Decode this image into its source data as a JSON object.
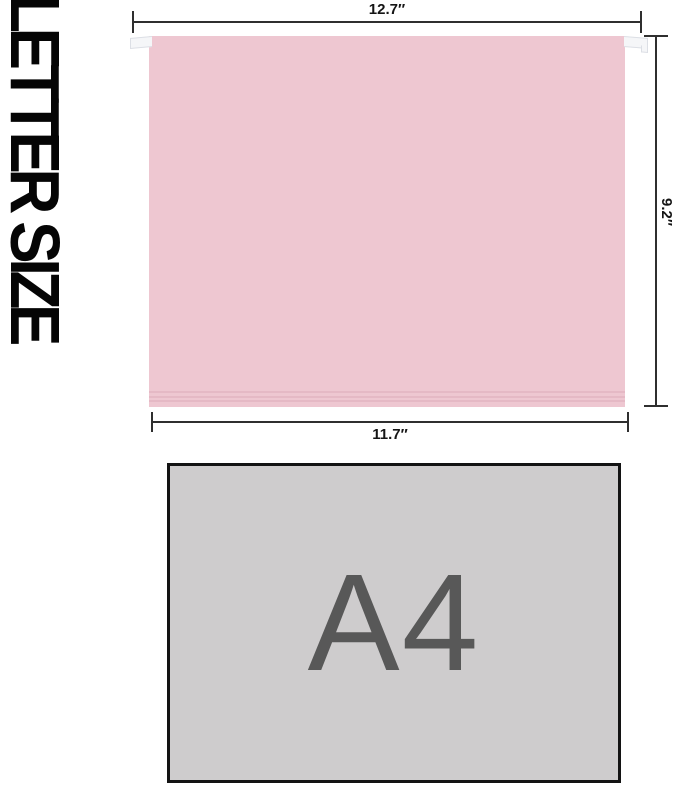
{
  "title": {
    "text": "LETTER SIZE"
  },
  "folder": {
    "type": "letter-size hanging file folder",
    "color": "#eec7d1",
    "top_width_label": "12.7″",
    "height_label": "9.2″",
    "bottom_width_label": "11.7″"
  },
  "a4": {
    "label": "A4",
    "fill": "#cecccd",
    "text_color": "#585858"
  },
  "colors": {
    "background": "#ffffff",
    "dimension_line": "#2f2f2f",
    "label_text": "#151515",
    "title_text": "#050505"
  }
}
